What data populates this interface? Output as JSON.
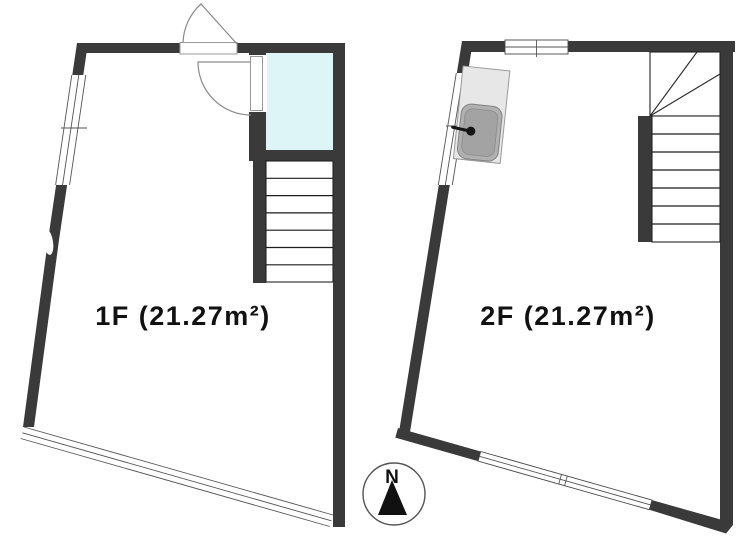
{
  "document": {
    "kind": "real-estate floor plan",
    "background": "#ffffff"
  },
  "colors": {
    "wall": "#3a3a3a",
    "bathroom_fill": "#ddf5f7",
    "counter_fill": "#e7e7e7",
    "sink_fill": "#b0b0b0"
  },
  "floor_1f": {
    "label": "1F (21.27m²)",
    "area_sqm": "21.27",
    "symbols": [
      "entrance-door-swing",
      "interior-door-swing",
      "bathroom-unit",
      "staircase-7-treads",
      "slanted-window-wall",
      "bottom-sliding-window"
    ]
  },
  "floor_2f": {
    "label": "2F (21.27m²)",
    "area_sqm": "21.27",
    "symbols": [
      "kitchen-sink-counter",
      "winder-staircase",
      "straight-flight-7-treads",
      "top-window",
      "slanted-window-wall",
      "bottom-window"
    ]
  },
  "compass": {
    "label": "N"
  }
}
